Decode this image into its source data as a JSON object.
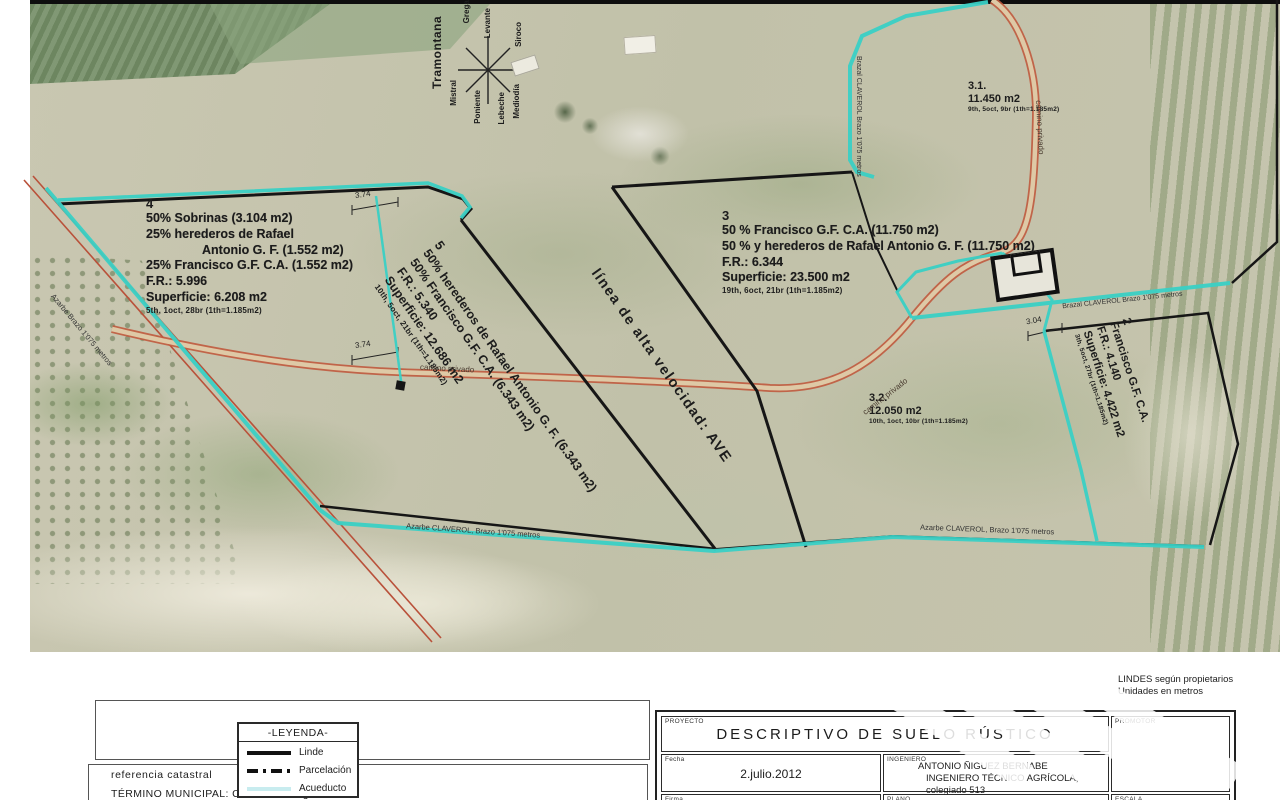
{
  "map": {
    "compass": {
      "winds": [
        "Tramontana",
        "Gregal",
        "Levante",
        "Siroco",
        "Mistral",
        "Poniente",
        "Lebeche",
        "Mediodía"
      ]
    },
    "notes": {
      "line1": "LINDES según propietarios",
      "line2": "Unidades en metros"
    },
    "labels": {
      "ave": "línea de alta velocidad: AVE",
      "camino_privado": "camino privado",
      "azarbe_left": "Azarbe Brazo 1'075 metros",
      "azarbe_bottom_left": "Azarbe CLAVEROL, Brazo 1'075 metros",
      "azarbe_bottom_right": "Azarbe CLAVEROL, Brazo 1'075 metros",
      "brazal_vertical": "Brazal CLAVEROL Brazo 1'075 metros",
      "brazal_diagonal": "Brazal CLAVEROL Brazo 1'075 metros"
    },
    "dimensions": {
      "d1": "3.74",
      "d2": "3.74",
      "d3": "3.04"
    },
    "parcels": {
      "p4": {
        "number": "4",
        "lines": [
          "50% Sobrinas (3.104 m2)",
          "25% herederos de Rafael",
          "Antonio G. F. (1.552 m2)",
          "25% Francisco G.F. C.A. (1.552 m2)",
          "F.R.: 5.996",
          "Superficie: 6.208 m2"
        ],
        "small": "5th, 1oct, 28br (1th=1.185m2)"
      },
      "p5": {
        "number": "5",
        "lines": [
          "50% herederos de Rafael Antonio G. F. (6.343 m2)",
          "50% Francisco G.F. C.A. (6.343 m2)",
          "F.R.: 5.340",
          "Superficie: 12.686 m2"
        ],
        "small": "10th, 5oct, 21br (1th=1.185m2)"
      },
      "p3": {
        "number": "3",
        "lines": [
          "50 % Francisco G.F. C.A. (11.750 m2)",
          "50 % y herederos de Rafael Antonio G. F. (11.750 m2)",
          "F.R.: 6.344",
          "Superficie: 23.500 m2"
        ],
        "small": "19th, 6oct, 21br (1th=1.185m2)"
      },
      "p31": {
        "number": "3.1.",
        "area": "11.450 m2",
        "small": "9th, 5oct, 9br (1th=1.185m2)"
      },
      "p32": {
        "number": "3.2.",
        "area": "12.050 m2",
        "small": "10th, 1oct, 10br (1th=1.185m2)"
      },
      "p2": {
        "number": "2",
        "lines": [
          "Francisco G.F. C.A.",
          "F.R.: 4.140",
          "Superficie: 4.422 m2"
        ],
        "small": "3th, 5oct, 27br (1th=1.185m2)"
      }
    },
    "colors": {
      "acueducto": "#3ad0c5",
      "linde": "#161616",
      "camino": "#c05a3e"
    }
  },
  "legend": {
    "title": "-LEYENDA-",
    "items": [
      {
        "label": "Linde"
      },
      {
        "label": "Parcelación"
      },
      {
        "label": "Acueducto"
      }
    ]
  },
  "cadastral": {
    "line1": "referencia catastral",
    "line2": "TÉRMINO MUNICIPAL: Callosa de Segura"
  },
  "titleblock": {
    "proyecto_label": "PROYECTO",
    "proyecto": "DESCRIPTIVO DE SUELO RÚSTICO",
    "fecha_label": "Fecha",
    "fecha": "2.julio.2012",
    "ingeniero_label": "INGENIERO",
    "ingeniero_1": "ANTONIO ÑIGUEZ BERNABE",
    "ingeniero_2": "INGENIERO TÉCNICO AGRÍCOLA, colegiado 513",
    "firma_label": "Firma",
    "plano_label": "PLANO",
    "plano": "REPRESENTACION GENERAL",
    "promotor_label": "PROMOTOR",
    "escala_label": "ESCALA",
    "escala": "1/1.200"
  }
}
